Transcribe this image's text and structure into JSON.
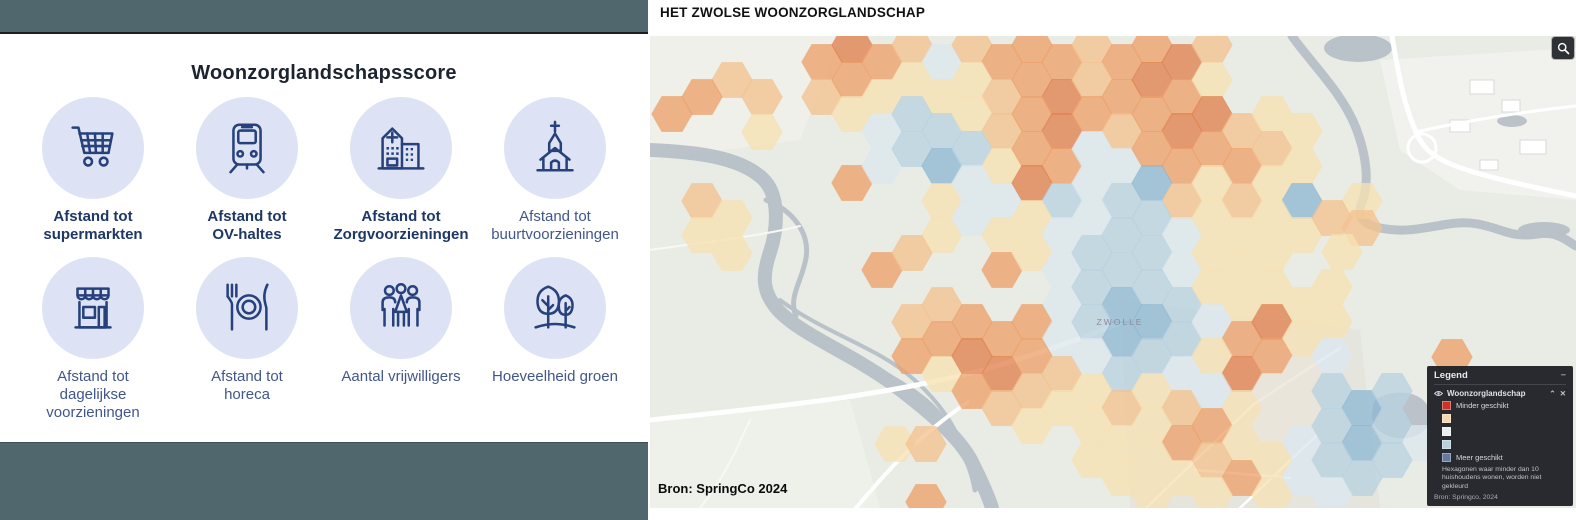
{
  "left_panel": {
    "title": "Woonzorglandschapsscore",
    "items": [
      {
        "icon": "shopping-cart-icon",
        "label": "Afstand tot\nsupermarkten",
        "bold": true
      },
      {
        "icon": "tram-icon",
        "label": "Afstand tot\nOV-haltes",
        "bold": true
      },
      {
        "icon": "hospital-icon",
        "label": "Afstand tot\nZorgvoorzieningen",
        "bold": true
      },
      {
        "icon": "church-icon",
        "label": "Afstand tot\nbuurtvoorzieningen",
        "bold": false
      },
      {
        "icon": "storefront-icon",
        "label": "Afstand tot\ndagelijkse\nvoorzieningen",
        "bold": false
      },
      {
        "icon": "restaurant-icon",
        "label": "Afstand tot\nhoreca",
        "bold": false
      },
      {
        "icon": "people-icon",
        "label": "Aantal vrijwilligers",
        "bold": false
      },
      {
        "icon": "trees-icon",
        "label": "Hoeveelheid groen",
        "bold": false
      }
    ],
    "colors": {
      "topbar": "#4f676d",
      "circle": "#dde3f4",
      "icon": "#26417b"
    }
  },
  "map_panel": {
    "title": "HET ZWOLSE WOONZORGLANDSCHAP",
    "attribution": "Bron: SpringCo 2024",
    "city_label": "ZWOLLE",
    "zoom_button": "magnifier",
    "legend": {
      "title": "Legend",
      "collapse_icon": "−",
      "layer_name": "Woonzorglandschap",
      "layer_icons": [
        "eye-icon",
        "chevron-up-icon",
        "close-icon"
      ],
      "swatches": [
        {
          "color": "#cb3327",
          "label": "Minder geschikt"
        },
        {
          "color": "#f7d7b1",
          "label": ""
        },
        {
          "color": "#e9eef2",
          "label": ""
        },
        {
          "color": "#b9d1df",
          "label": ""
        },
        {
          "color": "#64799f",
          "label": "Meer geschikt"
        }
      ],
      "note_line1": "Hexagonen waar minder dan 10",
      "note_line2": "huishoudens wonen, worden niet gekleurd",
      "source": "Bron: Springco, 2024"
    },
    "chart_data": {
      "type": "heatmap",
      "title": "Woonzorglandschap hexagon suitability map of Zwolle",
      "legend_scale": [
        "Minder geschikt",
        "Meer geschikt"
      ],
      "hex_radius": 20.2,
      "palette": {
        "o3": "#e28150",
        "o2": "#eda26c",
        "o1": "#f3c38f",
        "y": "#f6e2b4",
        "n": "#eae6d8",
        "b1": "#dce8ee",
        "b2": "#b9d2e0",
        "b3": "#8fb9d3"
      },
      "hexes": [
        [
          732,
          80,
          "o1"
        ],
        [
          702,
          97,
          "o2"
        ],
        [
          672,
          114,
          "o2"
        ],
        [
          762,
          97,
          "o1"
        ],
        [
          762,
          132,
          "y"
        ],
        [
          852,
          183,
          "o2"
        ],
        [
          702,
          201,
          "o1"
        ],
        [
          732,
          218,
          "y"
        ],
        [
          702,
          235,
          "y"
        ],
        [
          732,
          253,
          "y"
        ],
        [
          822,
          62,
          "o2"
        ],
        [
          852,
          45,
          "o3"
        ],
        [
          882,
          62,
          "o2"
        ],
        [
          912,
          45,
          "o1"
        ],
        [
          942,
          62,
          "b1"
        ],
        [
          972,
          45,
          "o1"
        ],
        [
          1002,
          62,
          "o2"
        ],
        [
          1032,
          45,
          "o2"
        ],
        [
          1062,
          62,
          "o2"
        ],
        [
          1092,
          45,
          "o1"
        ],
        [
          1122,
          62,
          "o2"
        ],
        [
          1152,
          45,
          "o2"
        ],
        [
          1182,
          62,
          "o3"
        ],
        [
          1212,
          45,
          "o1"
        ],
        [
          822,
          97,
          "o1"
        ],
        [
          852,
          80,
          "o2"
        ],
        [
          882,
          97,
          "y"
        ],
        [
          912,
          80,
          "y"
        ],
        [
          942,
          97,
          "y"
        ],
        [
          972,
          80,
          "y"
        ],
        [
          1002,
          97,
          "o1"
        ],
        [
          1032,
          80,
          "o2"
        ],
        [
          1062,
          97,
          "o3"
        ],
        [
          1092,
          80,
          "o1"
        ],
        [
          1122,
          97,
          "o2"
        ],
        [
          1152,
          80,
          "o3"
        ],
        [
          1182,
          97,
          "o2"
        ],
        [
          1212,
          80,
          "y"
        ],
        [
          852,
          114,
          "y"
        ],
        [
          882,
          131,
          "b1"
        ],
        [
          912,
          114,
          "b2"
        ],
        [
          942,
          131,
          "b2"
        ],
        [
          972,
          114,
          "y"
        ],
        [
          1002,
          131,
          "o1"
        ],
        [
          1032,
          114,
          "o2"
        ],
        [
          1062,
          131,
          "o3"
        ],
        [
          1092,
          114,
          "o2"
        ],
        [
          1122,
          131,
          "o1"
        ],
        [
          1152,
          114,
          "o2"
        ],
        [
          1182,
          131,
          "o3"
        ],
        [
          1212,
          114,
          "o3"
        ],
        [
          1242,
          131,
          "o1"
        ],
        [
          1272,
          114,
          "y"
        ],
        [
          1302,
          131,
          "y"
        ],
        [
          882,
          166,
          "b1"
        ],
        [
          912,
          149,
          "b2"
        ],
        [
          942,
          166,
          "b3"
        ],
        [
          972,
          149,
          "b2"
        ],
        [
          1002,
          166,
          "y"
        ],
        [
          1032,
          149,
          "o2"
        ],
        [
          1062,
          166,
          "o2"
        ],
        [
          1092,
          149,
          "b1"
        ],
        [
          1122,
          166,
          "b1"
        ],
        [
          1152,
          149,
          "o2"
        ],
        [
          1182,
          166,
          "o2"
        ],
        [
          1212,
          149,
          "o2"
        ],
        [
          1242,
          166,
          "o2"
        ],
        [
          1272,
          149,
          "o1"
        ],
        [
          1302,
          166,
          "y"
        ],
        [
          942,
          201,
          "y"
        ],
        [
          972,
          183,
          "b1"
        ],
        [
          1002,
          201,
          "b1"
        ],
        [
          1032,
          183,
          "o3"
        ],
        [
          1062,
          201,
          "b2"
        ],
        [
          1092,
          183,
          "b1"
        ],
        [
          1122,
          201,
          "b2"
        ],
        [
          1152,
          183,
          "b3"
        ],
        [
          1182,
          201,
          "o1"
        ],
        [
          1212,
          183,
          "y"
        ],
        [
          1242,
          201,
          "o1"
        ],
        [
          1272,
          183,
          "y"
        ],
        [
          1302,
          201,
          "b3"
        ],
        [
          1362,
          201,
          "y"
        ],
        [
          942,
          235,
          "y"
        ],
        [
          972,
          218,
          "b1"
        ],
        [
          1002,
          235,
          "y"
        ],
        [
          1032,
          218,
          "y"
        ],
        [
          1062,
          235,
          "b1"
        ],
        [
          1092,
          218,
          "b1"
        ],
        [
          1122,
          235,
          "b2"
        ],
        [
          1152,
          218,
          "b2"
        ],
        [
          1182,
          235,
          "b1"
        ],
        [
          1212,
          218,
          "y"
        ],
        [
          1242,
          235,
          "y"
        ],
        [
          1272,
          218,
          "y"
        ],
        [
          1302,
          235,
          "y"
        ],
        [
          1332,
          218,
          "o1"
        ],
        [
          1362,
          228,
          "o1"
        ],
        [
          882,
          270,
          "o2"
        ],
        [
          912,
          253,
          "o1"
        ],
        [
          1002,
          270,
          "o2"
        ],
        [
          1032,
          253,
          "y"
        ],
        [
          1062,
          270,
          "b1"
        ],
        [
          1092,
          253,
          "b2"
        ],
        [
          1122,
          270,
          "b2"
        ],
        [
          1152,
          253,
          "b2"
        ],
        [
          1182,
          270,
          "b1"
        ],
        [
          1212,
          253,
          "y"
        ],
        [
          1242,
          270,
          "y"
        ],
        [
          1272,
          253,
          "y"
        ],
        [
          1342,
          252,
          "y"
        ],
        [
          942,
          305,
          "o1"
        ],
        [
          1062,
          305,
          "b1"
        ],
        [
          1092,
          287,
          "b2"
        ],
        [
          1122,
          305,
          "b3"
        ],
        [
          1152,
          287,
          "b2"
        ],
        [
          1182,
          305,
          "b2"
        ],
        [
          1212,
          287,
          "y"
        ],
        [
          1242,
          305,
          "y"
        ],
        [
          1272,
          287,
          "y"
        ],
        [
          1302,
          305,
          "y"
        ],
        [
          1332,
          287,
          "y"
        ],
        [
          912,
          322,
          "o1"
        ],
        [
          942,
          339,
          "o2"
        ],
        [
          972,
          322,
          "o2"
        ],
        [
          1002,
          339,
          "o2"
        ],
        [
          1032,
          322,
          "o2"
        ],
        [
          1062,
          339,
          "b1"
        ],
        [
          1092,
          322,
          "b2"
        ],
        [
          1122,
          339,
          "b3"
        ],
        [
          1152,
          322,
          "b3"
        ],
        [
          1182,
          339,
          "b2"
        ],
        [
          1212,
          322,
          "b1"
        ],
        [
          1242,
          339,
          "o2"
        ],
        [
          1272,
          322,
          "o3"
        ],
        [
          1302,
          339,
          "y"
        ],
        [
          1332,
          322,
          "y"
        ],
        [
          912,
          356,
          "o2"
        ],
        [
          942,
          374,
          "y"
        ],
        [
          972,
          356,
          "o3"
        ],
        [
          1002,
          374,
          "o3"
        ],
        [
          1032,
          356,
          "o2"
        ],
        [
          1062,
          374,
          "o1"
        ],
        [
          1092,
          356,
          "b1"
        ],
        [
          1122,
          374,
          "b2"
        ],
        [
          1152,
          356,
          "b2"
        ],
        [
          1182,
          374,
          "b1"
        ],
        [
          1212,
          356,
          "y"
        ],
        [
          1242,
          374,
          "o3"
        ],
        [
          1272,
          356,
          "o2"
        ],
        [
          1302,
          374,
          "n"
        ],
        [
          1332,
          356,
          "b1"
        ],
        [
          972,
          391,
          "o2"
        ],
        [
          1002,
          408,
          "o1"
        ],
        [
          1032,
          391,
          "o1"
        ],
        [
          1062,
          408,
          "y"
        ],
        [
          1092,
          391,
          "y"
        ],
        [
          1122,
          408,
          "o1"
        ],
        [
          1152,
          391,
          "y"
        ],
        [
          1182,
          408,
          "o1"
        ],
        [
          1212,
          391,
          "b1"
        ],
        [
          1242,
          408,
          "y"
        ],
        [
          1272,
          391,
          "n"
        ],
        [
          1302,
          408,
          "n"
        ],
        [
          1332,
          391,
          "b2"
        ],
        [
          1362,
          408,
          "b3"
        ],
        [
          1392,
          391,
          "b2"
        ],
        [
          1032,
          426,
          "y"
        ],
        [
          1092,
          426,
          "y"
        ],
        [
          1122,
          443,
          "y"
        ],
        [
          1152,
          426,
          "y"
        ],
        [
          1182,
          443,
          "o2"
        ],
        [
          1212,
          426,
          "o2"
        ],
        [
          1242,
          443,
          "y"
        ],
        [
          1272,
          426,
          "n"
        ],
        [
          1302,
          443,
          "b1"
        ],
        [
          1332,
          426,
          "b2"
        ],
        [
          1362,
          443,
          "b3"
        ],
        [
          1392,
          426,
          "b2"
        ],
        [
          1422,
          443,
          "b1"
        ],
        [
          1092,
          460,
          "y"
        ],
        [
          1122,
          478,
          "y"
        ],
        [
          1152,
          460,
          "y"
        ],
        [
          1182,
          478,
          "y"
        ],
        [
          1212,
          460,
          "o1"
        ],
        [
          1242,
          478,
          "o2"
        ],
        [
          1272,
          460,
          "y"
        ],
        [
          1302,
          478,
          "b1"
        ],
        [
          1332,
          460,
          "b2"
        ],
        [
          1362,
          478,
          "b2"
        ],
        [
          1392,
          460,
          "b2"
        ],
        [
          1152,
          495,
          "y"
        ],
        [
          1212,
          495,
          "y"
        ],
        [
          1272,
          495,
          "y"
        ],
        [
          1332,
          495,
          "b1"
        ],
        [
          1452,
          357,
          "o2"
        ],
        [
          895,
          444,
          "y"
        ],
        [
          926,
          444,
          "o1"
        ],
        [
          926,
          502,
          "o2"
        ]
      ]
    }
  }
}
